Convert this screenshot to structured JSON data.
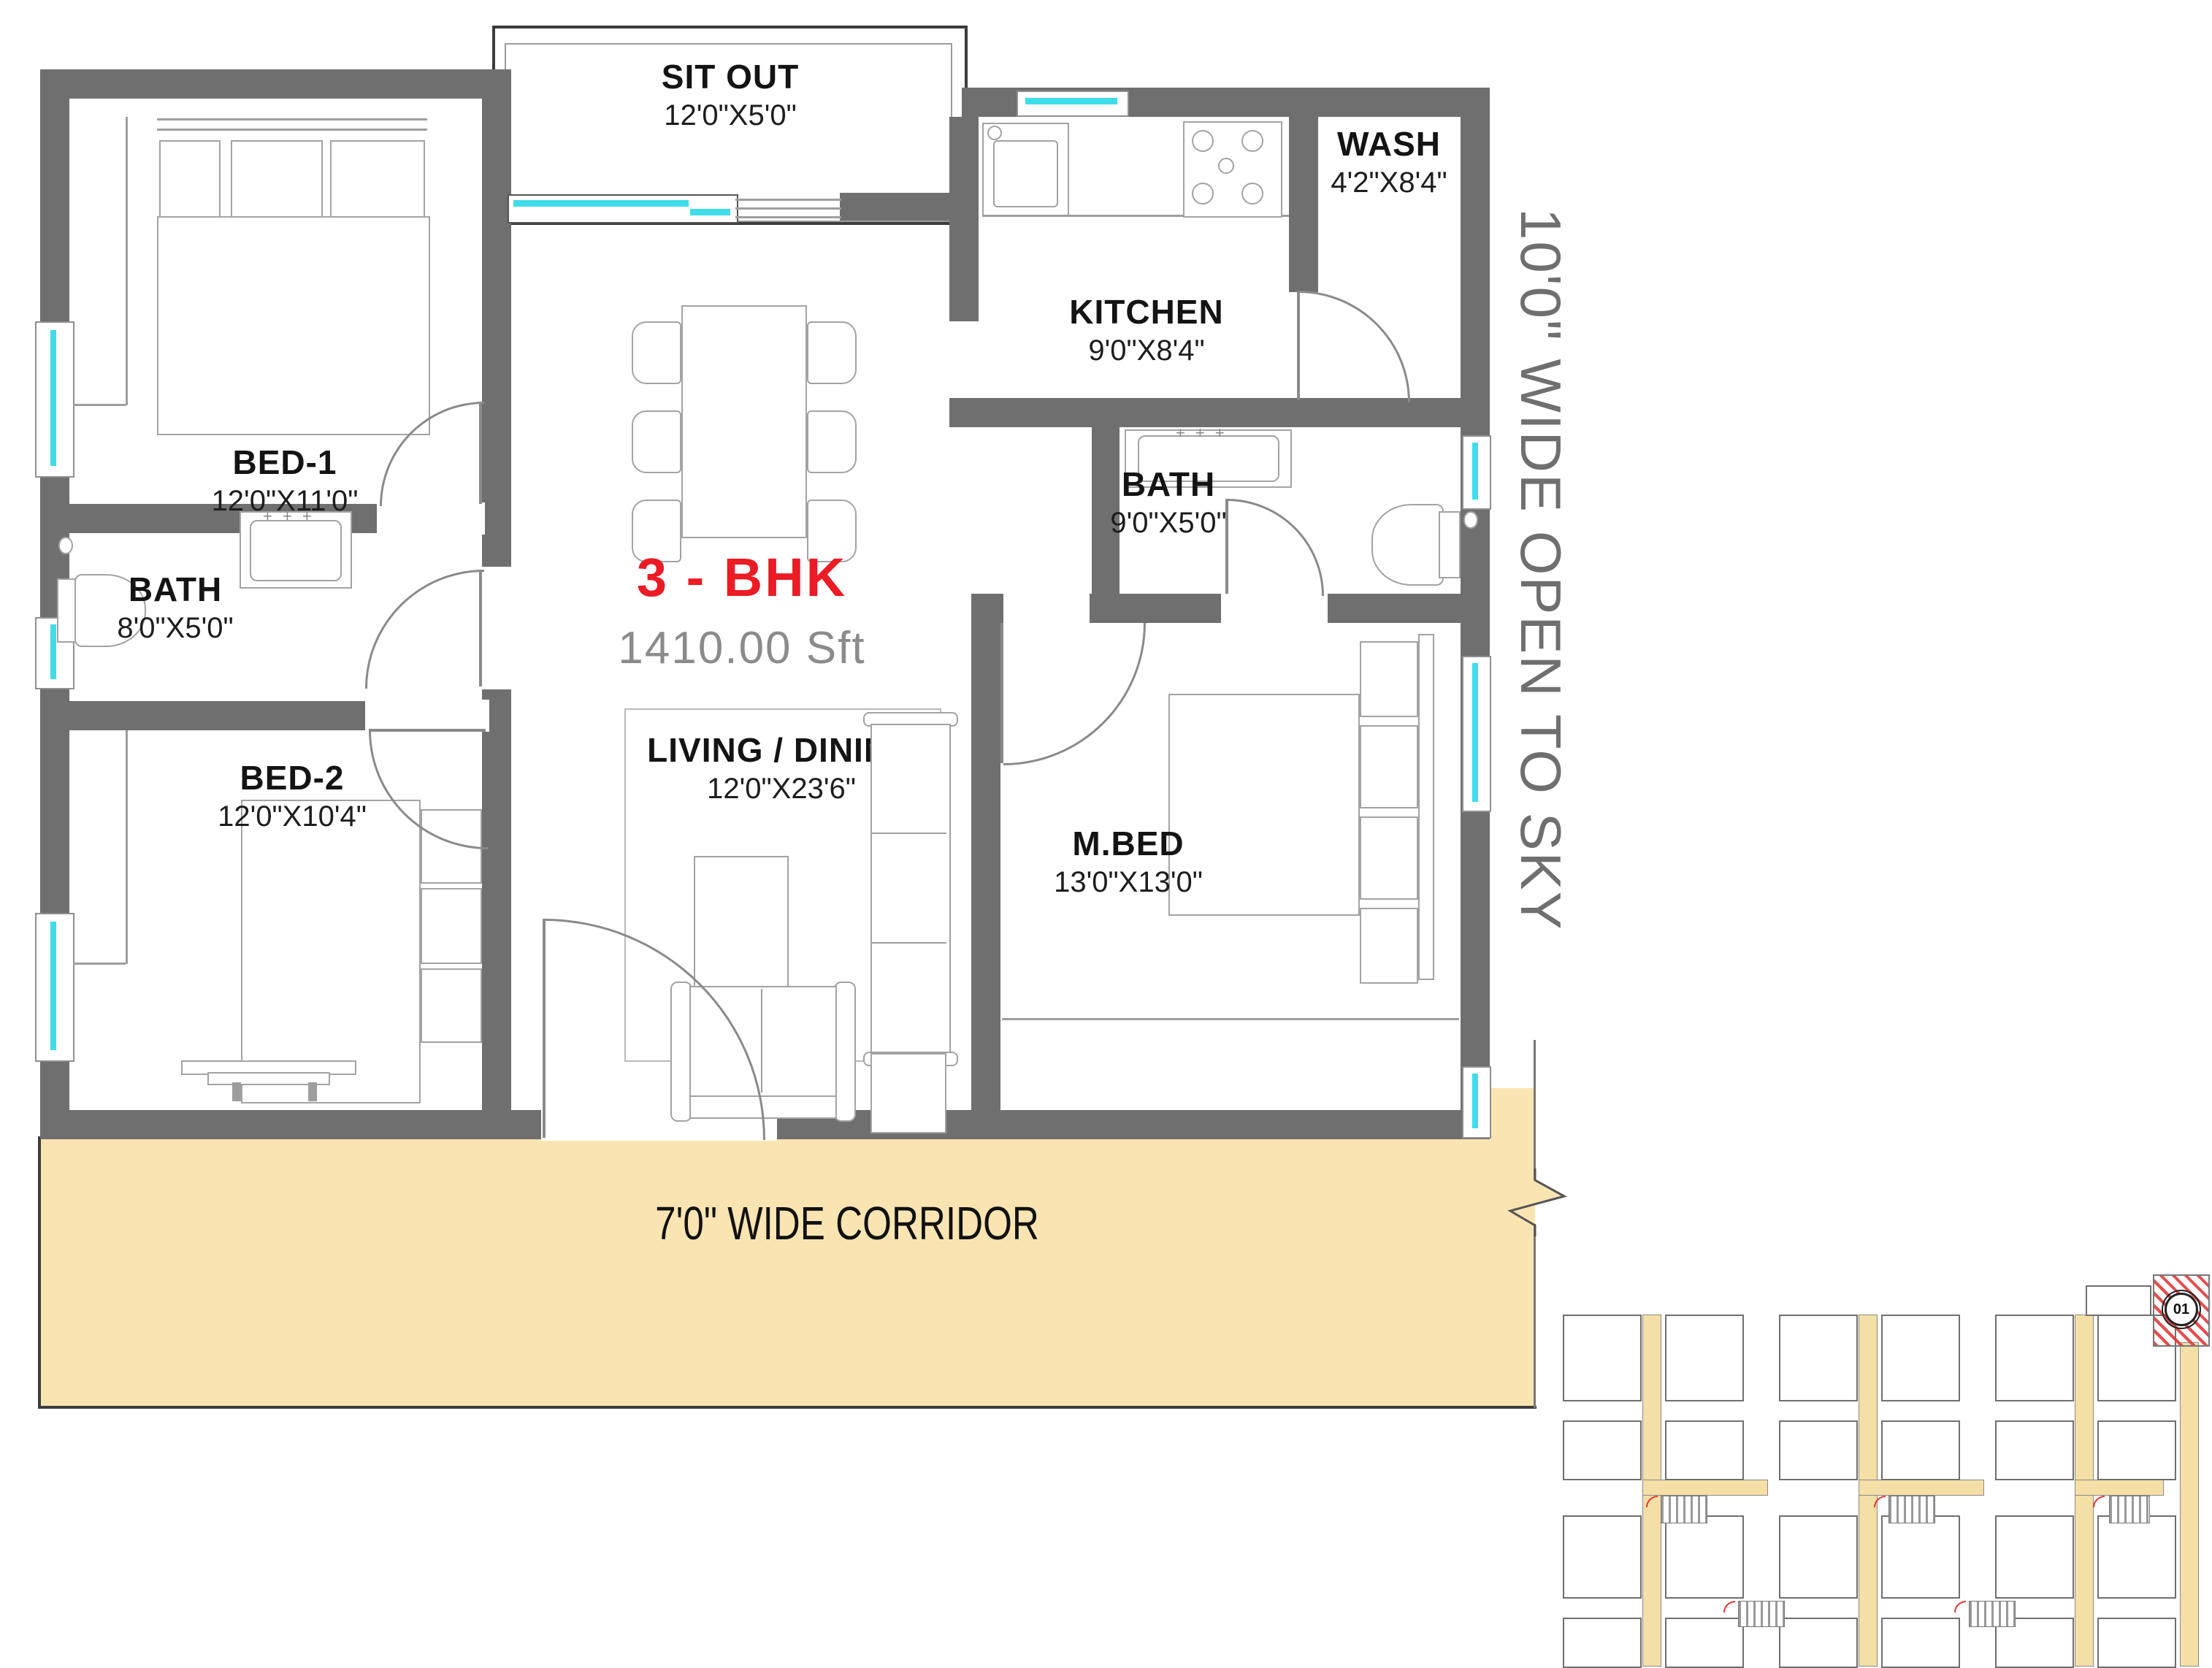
{
  "plan": {
    "title": "3 - BHK",
    "area": "1410.00 Sft",
    "open_to_sky_label": "10'0\" WIDE OPEN TO SKY",
    "corridor_label": "7'0\" WIDE CORRIDOR",
    "keyplan_unit_label": "01"
  },
  "rooms": {
    "bed1": {
      "name": "BED-1",
      "dims": "12'0\"X11'0\""
    },
    "bath_left": {
      "name": "BATH",
      "dims": "8'0\"X5'0\""
    },
    "bed2": {
      "name": "BED-2",
      "dims": "12'0\"X10'4\""
    },
    "sit_out": {
      "name": "SIT OUT",
      "dims": "12'0\"X5'0\""
    },
    "kitchen": {
      "name": "KITCHEN",
      "dims": "9'0\"X8'4\""
    },
    "wash": {
      "name": "WASH",
      "dims": "4'2\"X8'4\""
    },
    "bath_right": {
      "name": "BATH",
      "dims": "9'0\"X5'0\""
    },
    "mbed": {
      "name": "M.BED",
      "dims": "13'0\"X13'0\""
    },
    "living": {
      "name": "LIVING / DINING",
      "dims": "12'0\"X23'6\""
    }
  },
  "colors": {
    "wall": "#6F6F6F",
    "corridor_fill": "#FAE5B2",
    "window_accent": "#3EDDE9",
    "title_red": "#EC1B24",
    "area_gray": "#8B8B8B",
    "keyplan_hatch_red": "#E03A3A"
  }
}
